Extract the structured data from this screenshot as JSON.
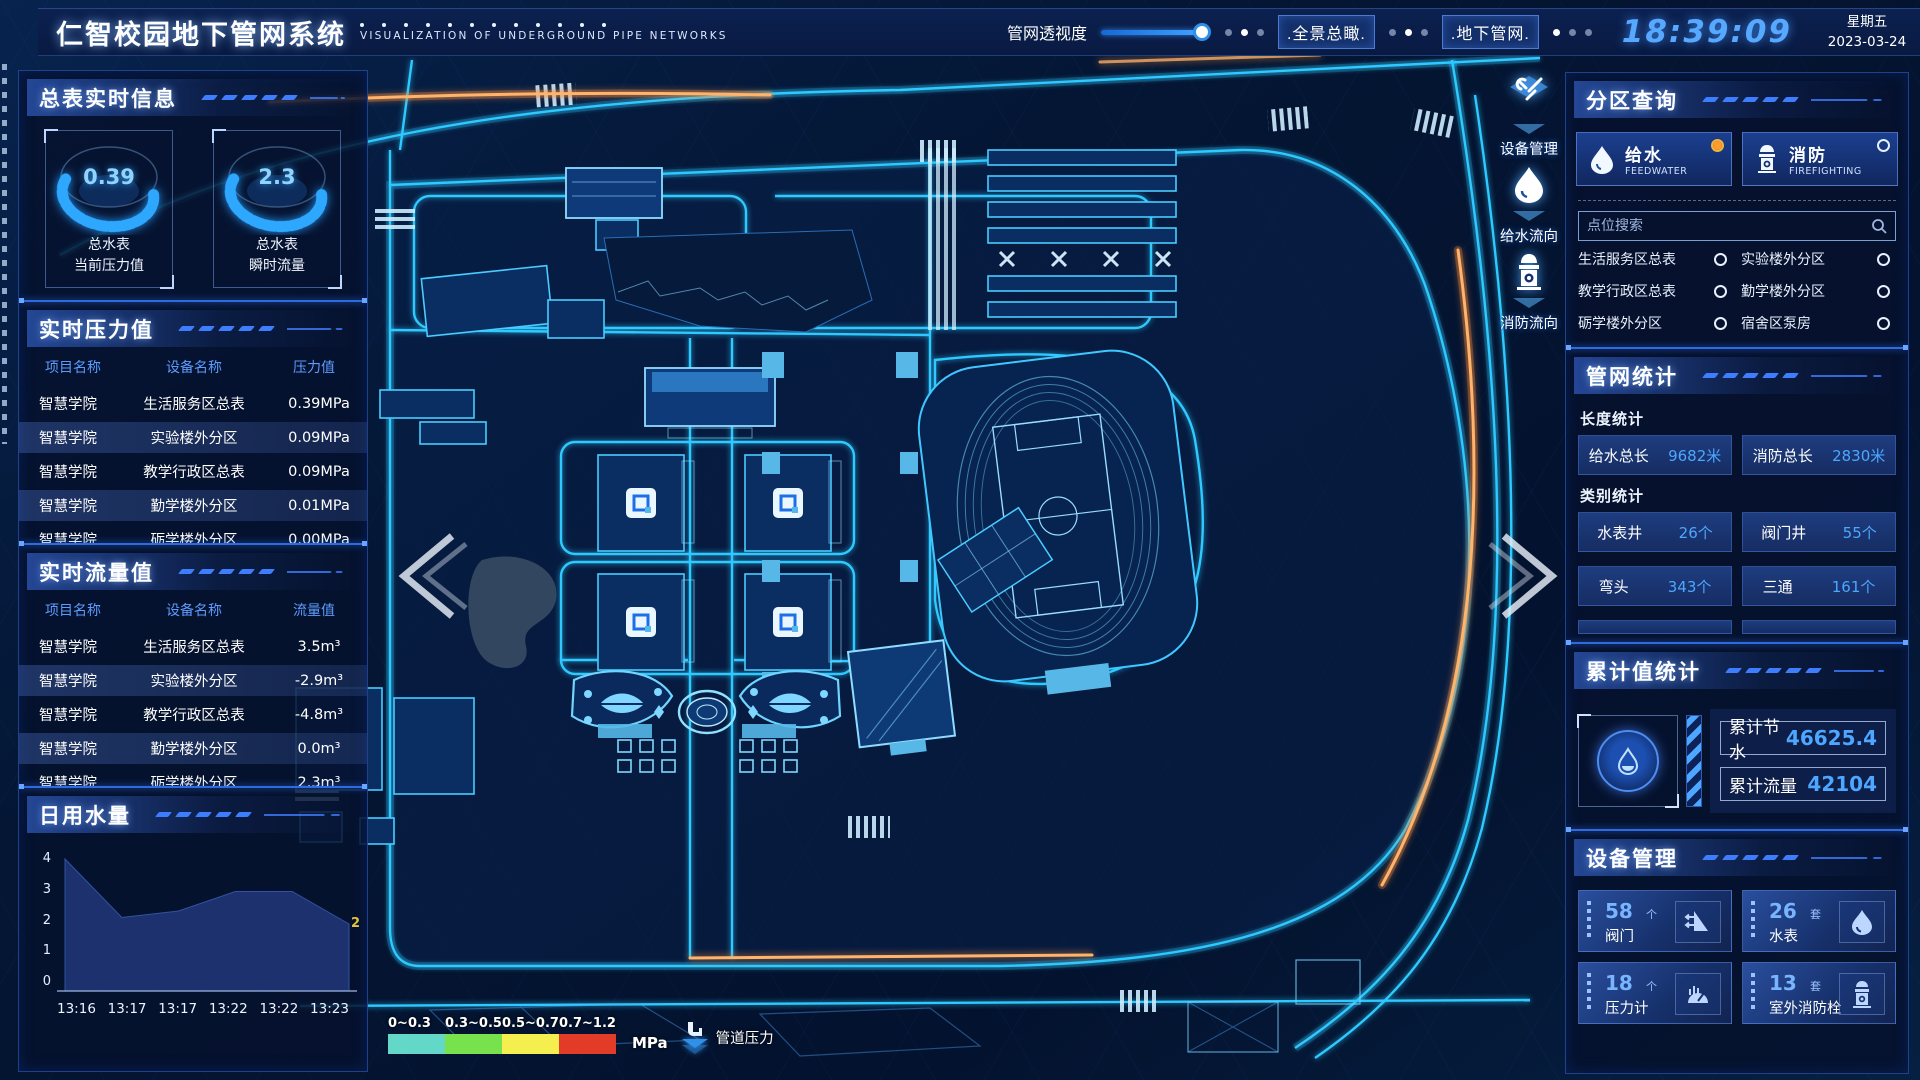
{
  "header": {
    "title": "仁智校园地下管网系统",
    "subtitle": "VISUALIZATION OF UNDERGROUND PIPE NETWORKS",
    "opacity_label": "管网透视度",
    "btn_overview": ".全景总瞰.",
    "btn_underground": ".地下管网.",
    "time": "18:39:09",
    "weekday": "星期五",
    "date": "2023-03-24"
  },
  "left": {
    "meter_info": {
      "title": "总表实时信息",
      "gauges": [
        {
          "value": "0.39",
          "line1": "总水表",
          "line2": "当前压力值"
        },
        {
          "value": "2.3",
          "line1": "总水表",
          "line2": "瞬时流量"
        }
      ]
    },
    "pressure": {
      "title": "实时压力值",
      "columns": [
        "项目名称",
        "设备名称",
        "压力值"
      ],
      "rows": [
        [
          "智慧学院",
          "生活服务区总表",
          "0.39MPa"
        ],
        [
          "智慧学院",
          "实验楼外分区",
          "0.09MPa"
        ],
        [
          "智慧学院",
          "教学行政区总表",
          "0.09MPa"
        ],
        [
          "智慧学院",
          "勤学楼外分区",
          "0.01MPa"
        ],
        [
          "智慧学院",
          "砺学楼外分区",
          "0.00MPa"
        ]
      ]
    },
    "flow": {
      "title": "实时流量值",
      "columns": [
        "项目名称",
        "设备名称",
        "流量值"
      ],
      "rows": [
        [
          "智慧学院",
          "生活服务区总表",
          "3.5m³"
        ],
        [
          "智慧学院",
          "实验楼外分区",
          "-2.9m³"
        ],
        [
          "智慧学院",
          "教学行政区总表",
          "-4.8m³"
        ],
        [
          "智慧学院",
          "勤学楼外分区",
          "0.0m³"
        ],
        [
          "智慧学院",
          "砺学楼外分区",
          "2.3m³"
        ]
      ]
    },
    "daily": {
      "title": "日用水量"
    }
  },
  "chart_data": {
    "type": "area",
    "title": "日用水量",
    "x": [
      "13:16",
      "13:17",
      "13:17",
      "13:22",
      "13:22",
      "13:23"
    ],
    "values": [
      4,
      2.2,
      2.4,
      3.0,
      3.0,
      2
    ],
    "yticks": [
      0,
      1,
      2,
      3,
      4
    ],
    "ylim": [
      0,
      4
    ],
    "end_label": "2",
    "fill": "#1b2d63",
    "line": "#31539f",
    "grid": false,
    "legend_position": "none"
  },
  "right": {
    "zone": {
      "title": "分区查询",
      "tabs": [
        {
          "label": "给水",
          "sub": "FEEDWATER",
          "selected": true
        },
        {
          "label": "消防",
          "sub": "FIREFIGHTING",
          "selected": false
        }
      ],
      "search_placeholder": "点位搜索",
      "items": [
        "生活服务区总表",
        "实验楼外分区",
        "教学行政区总表",
        "勤学楼外分区",
        "砺学楼外分区",
        "宿舍区泵房"
      ]
    },
    "pipe_stats": {
      "title": "管网统计",
      "length_label": "长度统计",
      "length_items": [
        {
          "name": "给水总长",
          "value": "9682米"
        },
        {
          "name": "消防总长",
          "value": "2830米"
        }
      ],
      "category_label": "类别统计",
      "category_items": [
        {
          "name": "水表井",
          "value": "26个"
        },
        {
          "name": "阀门井",
          "value": "55个"
        },
        {
          "name": "弯头",
          "value": "343个"
        },
        {
          "name": "三通",
          "value": "161个"
        }
      ]
    },
    "cumulative": {
      "title": "累计值统计",
      "items": [
        {
          "name": "累计节水",
          "value": "46625.4"
        },
        {
          "name": "累计流量",
          "value": "42104"
        }
      ]
    },
    "devices": {
      "title": "设备管理",
      "cards": [
        {
          "count": "58",
          "unit": "个",
          "name": "阀门"
        },
        {
          "count": "26",
          "unit": "套",
          "name": "水表"
        },
        {
          "count": "18",
          "unit": "个",
          "name": "压力计"
        },
        {
          "count": "13",
          "unit": "套",
          "name": "室外消防栓"
        }
      ]
    }
  },
  "map": {
    "tools": [
      {
        "label": "设备管理",
        "icon": "tools-icon"
      },
      {
        "label": "给水流向",
        "icon": "water-drop-icon"
      },
      {
        "label": "消防流向",
        "icon": "hydrant-icon"
      }
    ],
    "legend": {
      "ranges": [
        "0~0.3",
        "0.3~0.5",
        "0.5~0.7",
        "0.7~1.2"
      ],
      "colors": [
        "#63d8c9",
        "#78e24d",
        "#f4ee4e",
        "#e23b28"
      ],
      "unit": "MPa",
      "label": "管道压力"
    }
  }
}
